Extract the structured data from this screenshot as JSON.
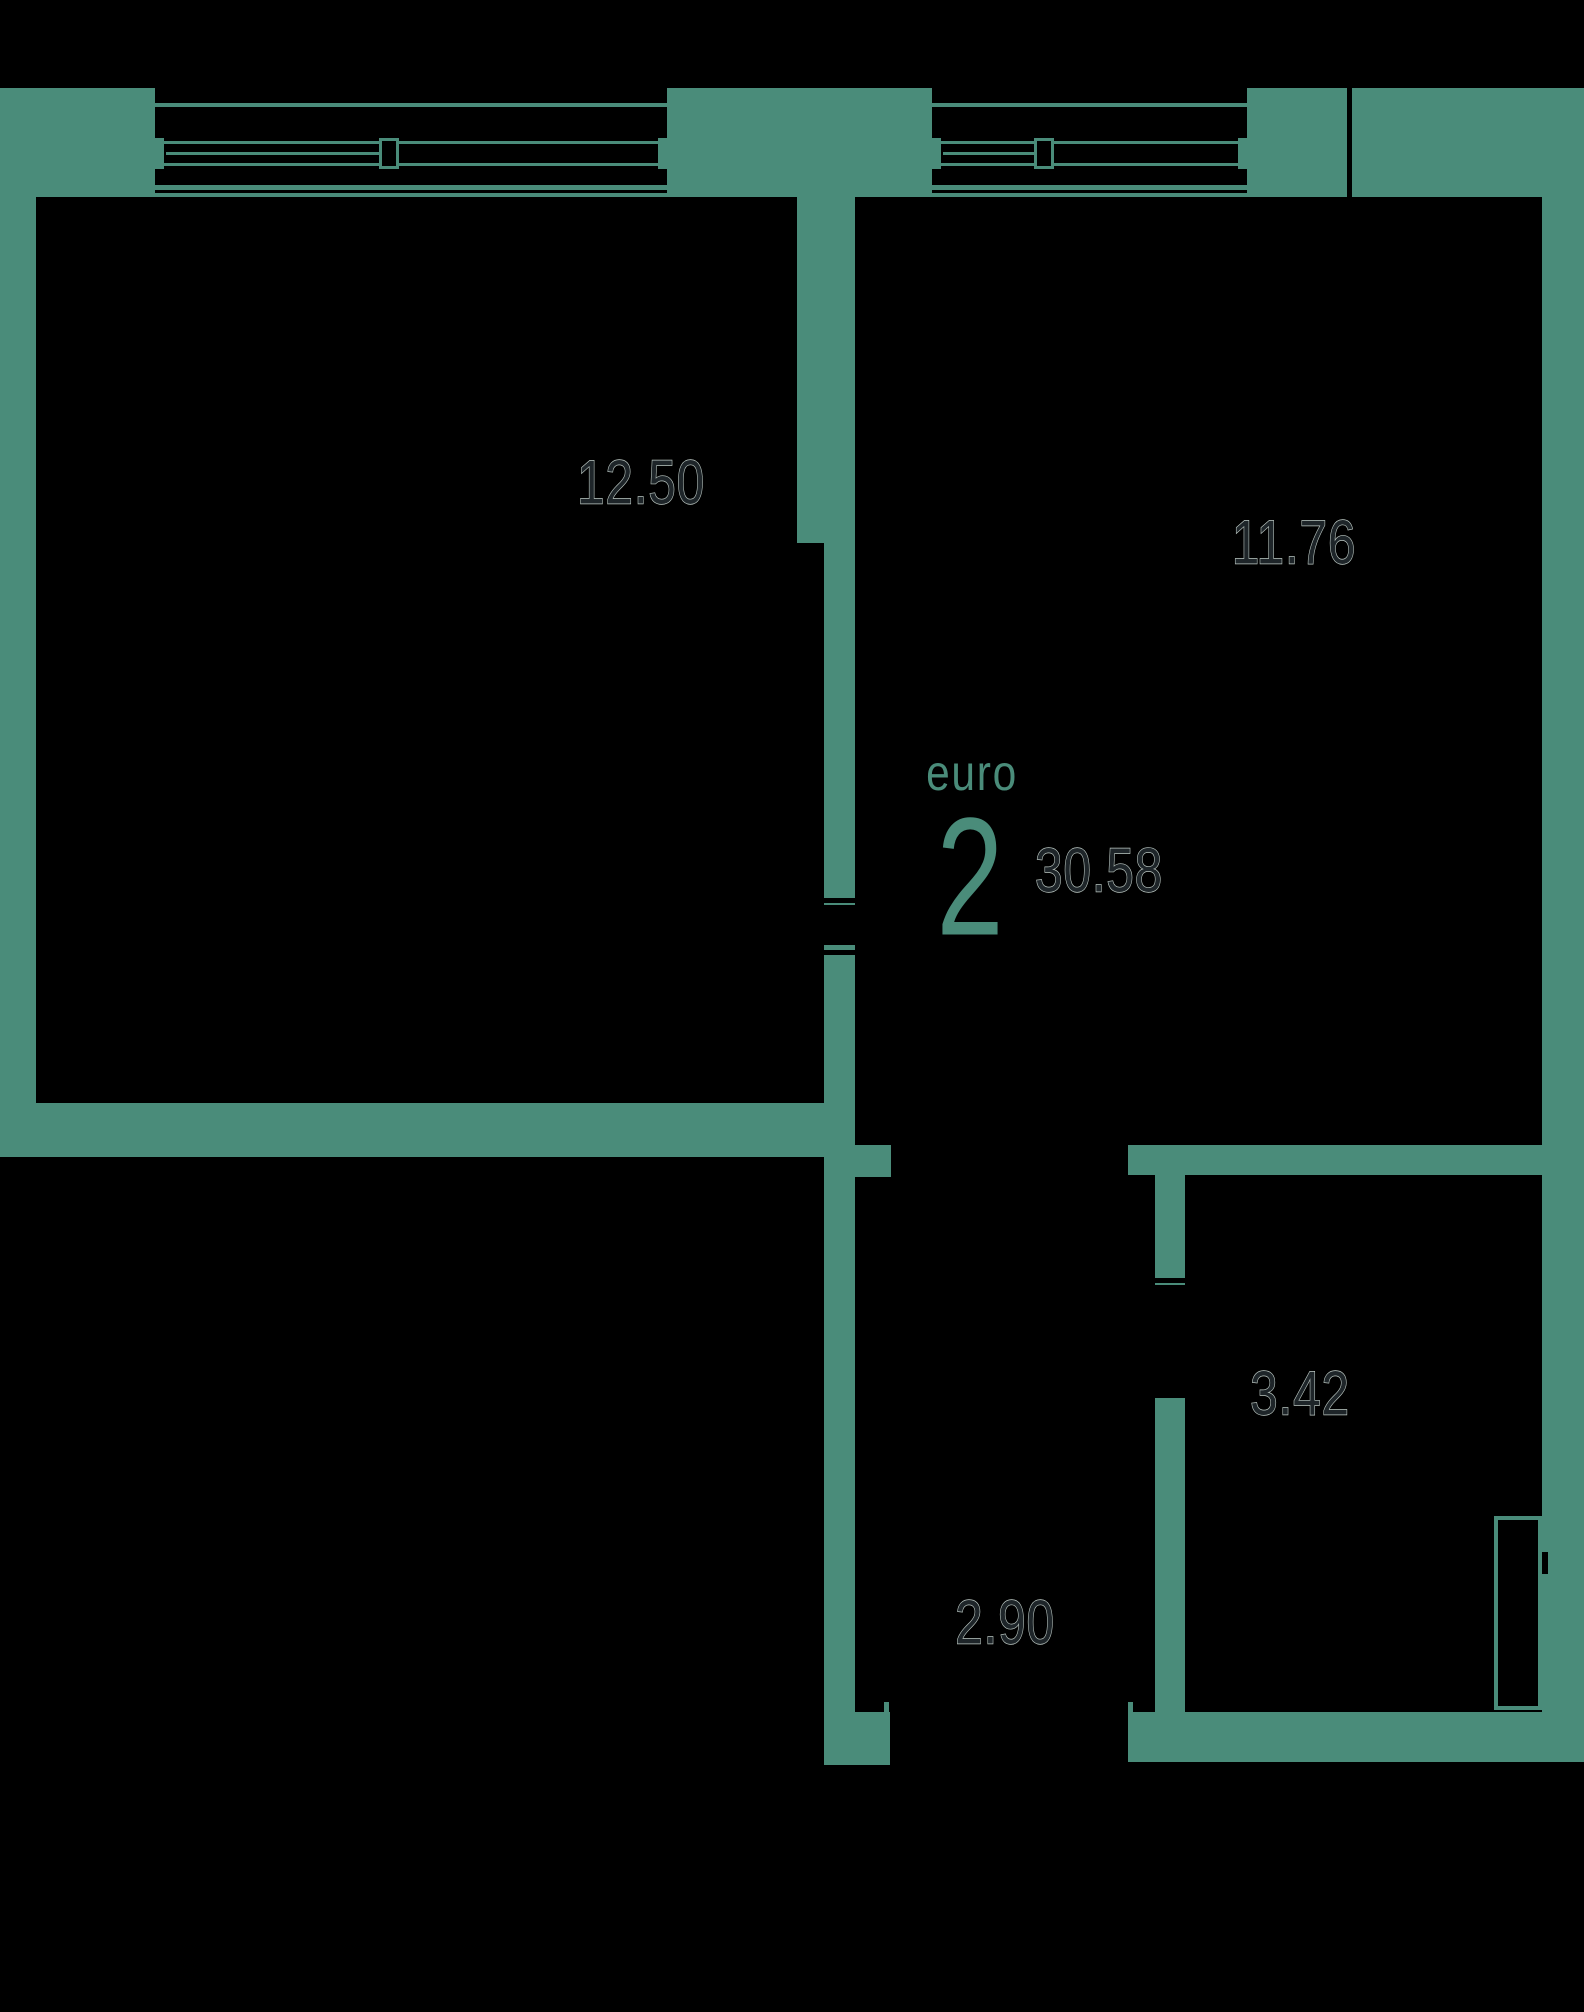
{
  "floorplan": {
    "unit_type_label": "euro",
    "room_count": "2",
    "total_area": "30.58",
    "rooms": [
      {
        "id": "room-1",
        "area": "12.50"
      },
      {
        "id": "room-2",
        "area": "11.76"
      },
      {
        "id": "bathroom",
        "area": "3.42"
      },
      {
        "id": "hallway",
        "area": "2.90"
      }
    ],
    "colors": {
      "wall": "#4a8c7a",
      "background": "#000000",
      "area_text": "#1e2529",
      "area_text_halo": "#c6d3cd",
      "accent_text": "#4a8c7a"
    }
  }
}
